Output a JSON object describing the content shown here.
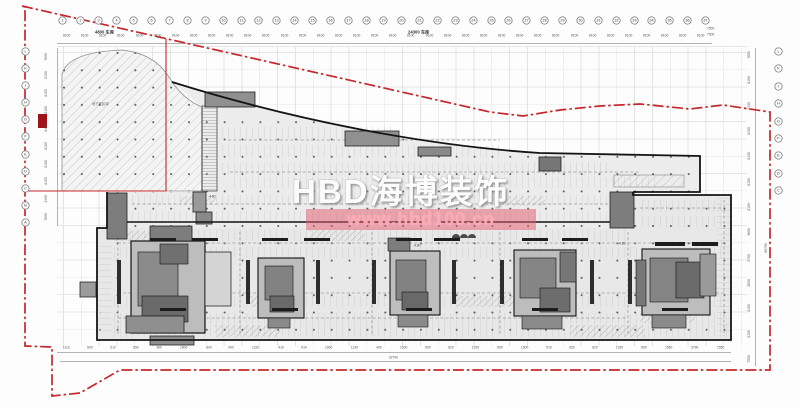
{
  "watermark": {
    "brand": "HBD海博装饰",
    "url": "www.hbd100.cn"
  },
  "colors": {
    "red_boundary": "#c5272b",
    "pink_bar": "#e25d71",
    "core_dark": "#6a6a6a",
    "plan_fill": "#ececec"
  },
  "grid": {
    "top_bubbles": [
      "1",
      "2",
      "3",
      "4",
      "5",
      "6",
      "7",
      "8",
      "9",
      "10",
      "11",
      "12",
      "13",
      "14",
      "15",
      "16",
      "17",
      "18",
      "19",
      "20",
      "21",
      "22",
      "23",
      "24",
      "25",
      "26",
      "27",
      "28",
      "29",
      "30",
      "31",
      "32",
      "33",
      "34",
      "35",
      "36",
      "37"
    ],
    "left_bubbles": [
      "L",
      "K",
      "J",
      "H",
      "G",
      "F",
      "E",
      "D",
      "C",
      "B",
      "A"
    ],
    "right_bubbles": [
      "L",
      "K",
      "J",
      "H",
      "G",
      "F",
      "E",
      "D",
      "C"
    ]
  },
  "dims": {
    "top_label_left": "4800 车库",
    "top_label_mid": "24300 车库",
    "top_right": [
      "7500",
      "7500"
    ],
    "top_bays": [
      "8100",
      "8100",
      "8100",
      "8100",
      "8100",
      "8100",
      "8100",
      "8100",
      "8100",
      "8100",
      "8100",
      "8100",
      "8100",
      "8100",
      "8100",
      "8100",
      "8100",
      "8100",
      "8100",
      "8100",
      "8100",
      "8100",
      "8100",
      "8100",
      "8100",
      "8100",
      "8100",
      "8100",
      "8100",
      "8100",
      "8100",
      "8100",
      "8100",
      "8100",
      "8100",
      "8100"
    ],
    "left_dims": [
      "7600",
      "8100",
      "8100",
      "8100",
      "8100",
      "8100",
      "8100",
      "8100",
      "4100",
      "7800"
    ],
    "right_dims": [
      "7600",
      "8100",
      "8100",
      "8100",
      "8100",
      "8100",
      "8100",
      "3600",
      "5750",
      "3600",
      "8100",
      "8100",
      "7000"
    ],
    "right_total": "69700",
    "bottom_dims": [
      "1110",
      "600",
      "510",
      "850",
      "360",
      "1900",
      "800",
      "900",
      "1220",
      "910",
      "910",
      "1900",
      "1130",
      "400",
      "1000",
      "800",
      "820",
      "1150",
      "890",
      "1900",
      "910",
      "820",
      "820",
      "1150",
      "890",
      "1560",
      "3790",
      "1550"
    ],
    "bottom_total": "32790"
  },
  "labels": {
    "hatch_area": "地下室区域",
    "elevation": "-4.80"
  }
}
